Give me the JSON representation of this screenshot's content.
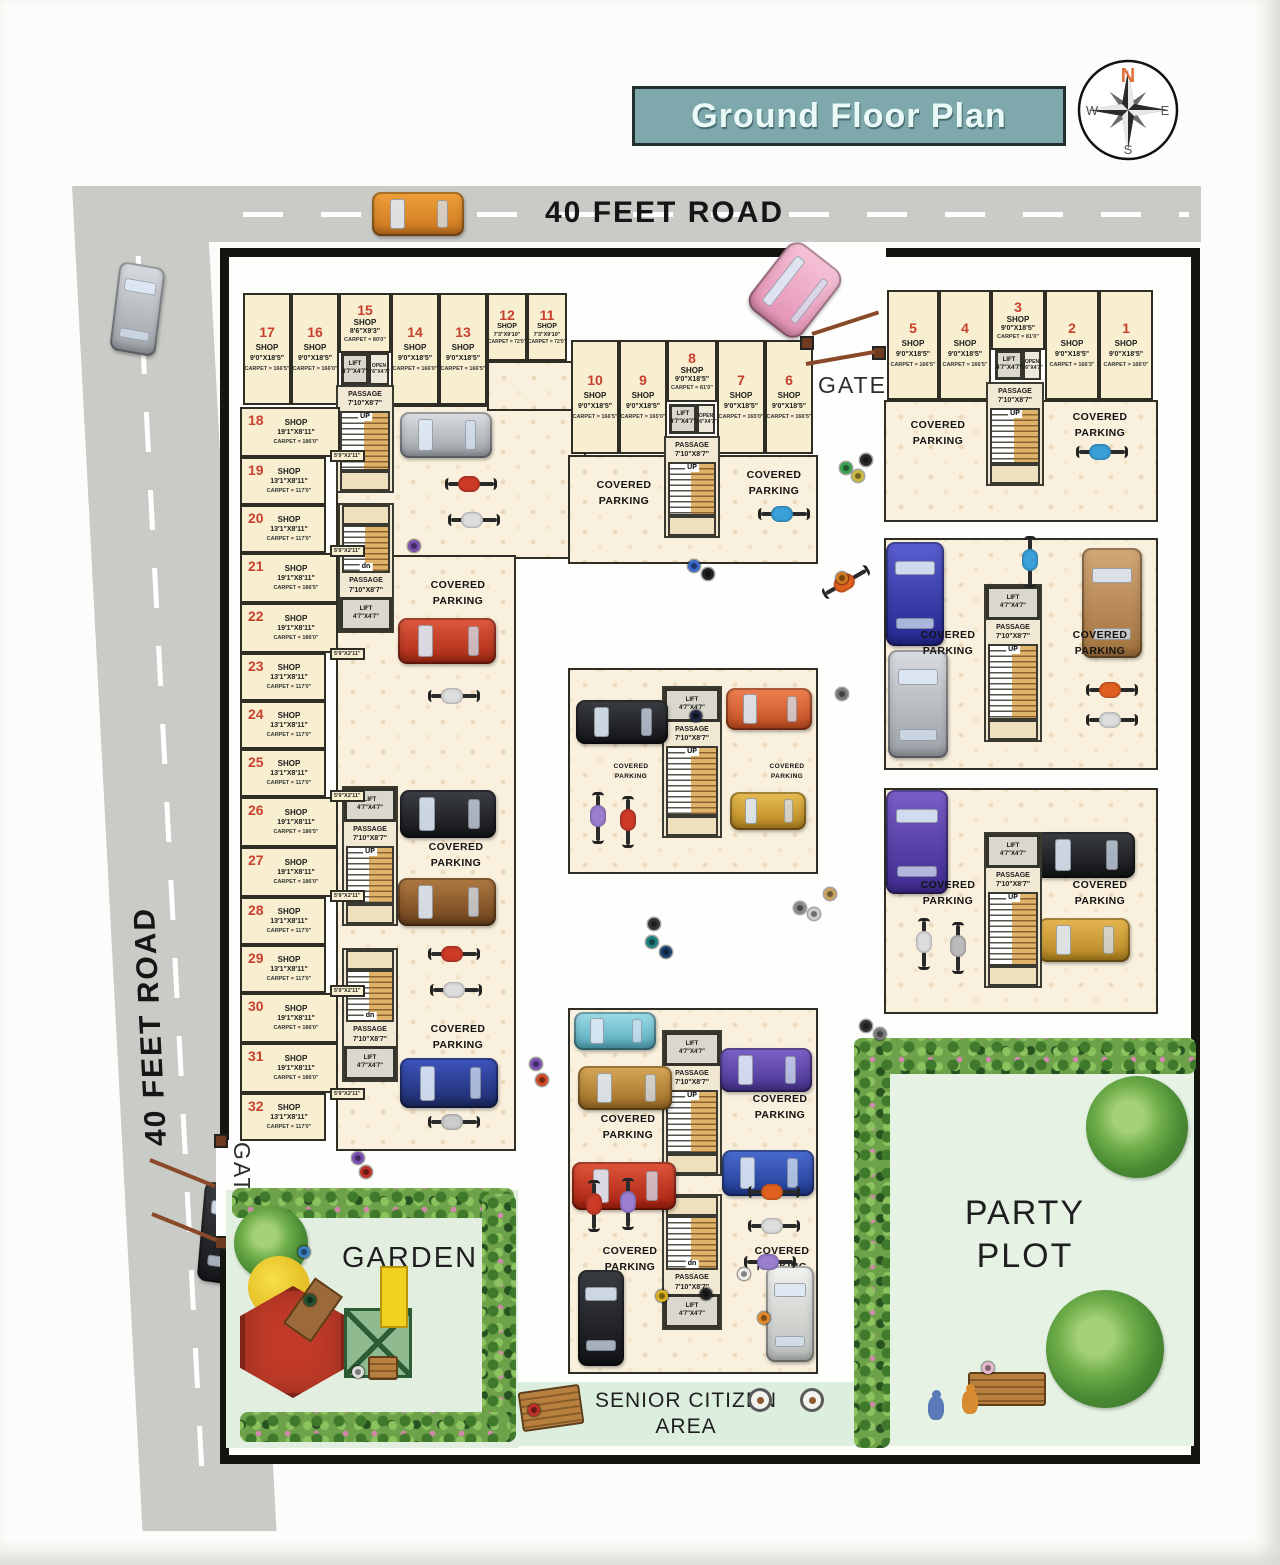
{
  "title": "Ground Floor Plan",
  "compass": {
    "n": "N",
    "e": "E",
    "s": "S",
    "w": "W"
  },
  "roads": {
    "top": "40 FEET ROAD",
    "left": "40 FEET ROAD"
  },
  "gate_label": "GATE",
  "areas": {
    "garden": "GARDEN",
    "party_line1": "PARTY",
    "party_line2": "PLOT",
    "senior_line1": "SENIOR CITIZEN",
    "senior_line2": "AREA"
  },
  "labels": {
    "shop": "SHOP",
    "covered": "COVERED",
    "parking": "PARKING",
    "passage": "PASSAGE",
    "passage_dims": "7'10\"X8'7\"",
    "lift": "LIFT",
    "lift_dims": "4'7\"X4'7\"",
    "open": "OPEN",
    "open_dims": "2'6\"X4'7\"",
    "up": "UP",
    "dn": "dn",
    "side_gap": "5'9\"X2'11\""
  },
  "shops": {
    "s1": {
      "no": "1",
      "dims": "9'0\"X18'5\"",
      "carpet": "CARPET = 166'0\""
    },
    "s2": {
      "no": "2",
      "dims": "9'0\"X18'5\"",
      "carpet": "CARPET = 166'3\""
    },
    "s3": {
      "no": "3",
      "dims": "9'0\"X18'5\"",
      "carpet": "CARPET = 81'0\""
    },
    "s4": {
      "no": "4",
      "dims": "9'0\"X18'5\"",
      "carpet": "CARPET = 166'5\""
    },
    "s5": {
      "no": "5",
      "dims": "9'0\"X18'5\"",
      "carpet": "CARPET = 166'5\""
    },
    "s6": {
      "no": "6",
      "dims": "9'0\"X18'5\"",
      "carpet": "CARPET = 166'5\""
    },
    "s7": {
      "no": "7",
      "dims": "9'0\"X18'5\"",
      "carpet": "CARPET = 165'0\""
    },
    "s8": {
      "no": "8",
      "dims": "9'0\"X18'5\"",
      "carpet": "CARPET = 81'0\""
    },
    "s9": {
      "no": "9",
      "dims": "9'0\"X18'5\"",
      "carpet": "CARPET = 165'0\""
    },
    "s10": {
      "no": "10",
      "dims": "9'0\"X18'5\"",
      "carpet": "CARPET = 166'5\""
    },
    "s11": {
      "no": "11",
      "dims": "7'3\"X9'10\"",
      "carpet": "CARPET = 72'0\""
    },
    "s12": {
      "no": "12",
      "dims": "7'3\"X9'10\"",
      "carpet": "CARPET = 72'0\""
    },
    "s13": {
      "no": "13",
      "dims": "9'0\"X18'5\"",
      "carpet": "CARPET = 166'5\""
    },
    "s14": {
      "no": "14",
      "dims": "9'0\"X18'5\"",
      "carpet": "CARPET = 166'0\""
    },
    "s15": {
      "no": "15",
      "dims": "8'6\"X9'3\"",
      "carpet": "CARPET = 80'0\""
    },
    "s16": {
      "no": "16",
      "dims": "9'0\"X18'5\"",
      "carpet": "CARPET = 166'0\""
    },
    "s17": {
      "no": "17",
      "dims": "9'0\"X18'5\"",
      "carpet": "CARPET = 166'5\""
    },
    "s18": {
      "no": "18",
      "dims": "19'1\"X8'11\"",
      "carpet": "CARPET = 186'0\""
    },
    "s19": {
      "no": "19",
      "dims": "13'1\"X8'11\"",
      "carpet": "CARPET = 117'0\""
    },
    "s20": {
      "no": "20",
      "dims": "13'1\"X8'11\"",
      "carpet": "CARPET = 117'0\""
    },
    "s21": {
      "no": "21",
      "dims": "19'1\"X8'11\"",
      "carpet": "CARPET = 186'5\""
    },
    "s22": {
      "no": "22",
      "dims": "19'1\"X8'11\"",
      "carpet": "CARPET = 186'0\""
    },
    "s23": {
      "no": "23",
      "dims": "13'1\"X8'11\"",
      "carpet": "CARPET = 117'0\""
    },
    "s24": {
      "no": "24",
      "dims": "13'1\"X8'11\"",
      "carpet": "CARPET = 117'0\""
    },
    "s25": {
      "no": "25",
      "dims": "13'1\"X8'11\"",
      "carpet": "CARPET = 117'0\""
    },
    "s26": {
      "no": "26",
      "dims": "19'1\"X8'11\"",
      "carpet": "CARPET = 186'5\""
    },
    "s27": {
      "no": "27",
      "dims": "19'1\"X8'11\"",
      "carpet": "CARPET = 186'0\""
    },
    "s28": {
      "no": "28",
      "dims": "13'1\"X8'11\"",
      "carpet": "CARPET = 117'0\""
    },
    "s29": {
      "no": "29",
      "dims": "13'1\"X8'11\"",
      "carpet": "CARPET = 117'0\""
    },
    "s30": {
      "no": "30",
      "dims": "19'1\"X8'11\"",
      "carpet": "CARPET = 186'0\""
    },
    "s31": {
      "no": "31",
      "dims": "19'1\"X8'11\"",
      "carpet": "CARPET = 186'0\""
    },
    "s32": {
      "no": "32",
      "dims": "13'1\"X8'11\"",
      "carpet": "CARPET = 117'0\""
    }
  },
  "colors": {
    "title_bg": "#7fa8ac",
    "road": "#c9cbc7",
    "shop_fill": "#f7efcf",
    "shop_number": "#c8402e",
    "boundary": "#15150f",
    "garden": "#e2efe0",
    "party_plot": "#e6f3e4",
    "senior": "#dcefdf",
    "north_letter": "#e0703a"
  }
}
